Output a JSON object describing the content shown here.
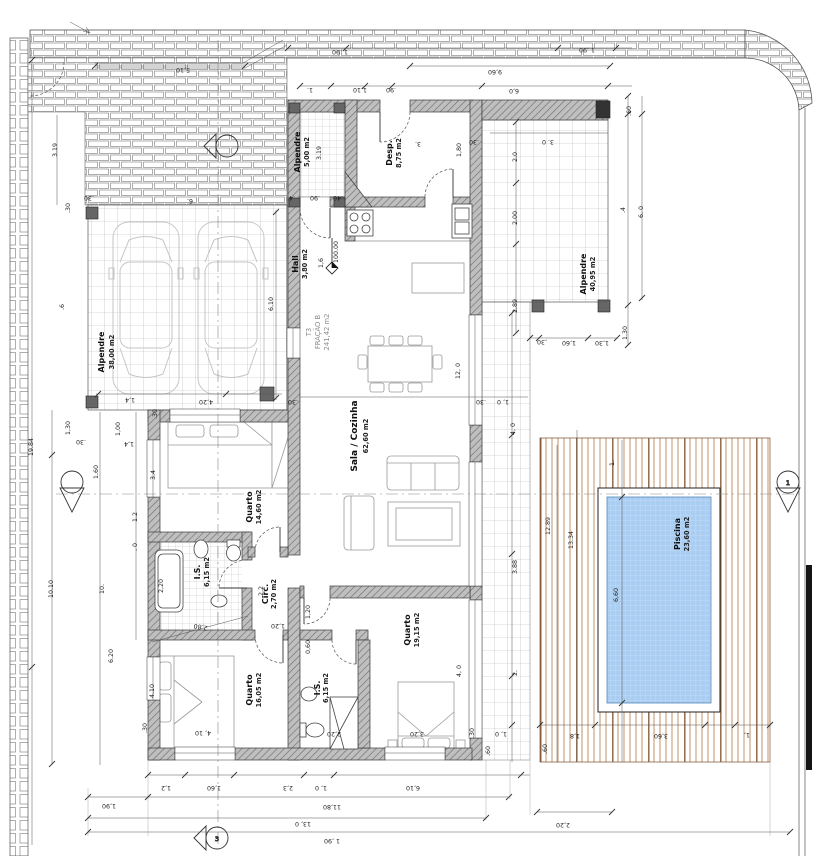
{
  "rooms": [
    {
      "name": "Alpendre",
      "area": "38,00 m2"
    },
    {
      "name": "Alpendre",
      "area": "5,00 m2"
    },
    {
      "name": "Desp.",
      "area": "8,75 m2"
    },
    {
      "name": "Hall",
      "area": "3,80 m2"
    },
    {
      "name": "Sala / Cozinha",
      "area": "62,60 m2"
    },
    {
      "name": "Quarto",
      "area": "14,60 m2"
    },
    {
      "name": "I.S.",
      "area": "6,15 m2"
    },
    {
      "name": "Circ.",
      "area": "2,70 m2"
    },
    {
      "name": "Quarto",
      "area": "16,05 m2"
    },
    {
      "name": "I.S.",
      "area": "6,15 m2"
    },
    {
      "name": "Quarto",
      "area": "19,15 m2"
    },
    {
      "name": "Alpendre",
      "area": "40,95 m2"
    },
    {
      "name": "Piscina",
      "area": "23,60 m2"
    }
  ],
  "unit": {
    "l1": "T3",
    "l2": "FRAÇÃO B",
    "l3": "241,42 m2"
  },
  "level": {
    "value": "100.00"
  },
  "markers": {
    "top": "",
    "left": "",
    "right": "1",
    "bottom": "3"
  },
  "dims": [
    "1 ,90",
    "1 ,90",
    "5,10",
    "9,60",
    "1.",
    "1,10",
    ".90",
    "6,0",
    "3.",
    "1,80",
    ".30",
    "3. 0",
    "2.0",
    "2.00",
    "2.89",
    ".60",
    ".4",
    "6. 0",
    "1.30",
    ",30",
    "1,60",
    "1,30",
    "3.19",
    ".30",
    ".30",
    "6.",
    "19.84",
    ".6",
    "6.10",
    "4,20",
    "1,4",
    ".30",
    "1,00",
    "1,4",
    "1,30",
    ".30",
    ".4",
    ".90",
    ".40",
    "3.4",
    "1.60",
    "1.2",
    ". 0",
    "10.10",
    "10.",
    "6.20",
    "4.10",
    ".30",
    "2,20",
    "2.2",
    "2,80",
    "1,20",
    "0,60",
    "2,20",
    "3,20",
    "4, 0",
    "12, 0",
    ".30",
    ".30",
    "1, 0",
    "4, 0",
    "3.88",
    "2.",
    ".30",
    "1, 0",
    ".60",
    ".60",
    "12.89",
    "13.34",
    "1.",
    "6,60",
    "1,8",
    "3,60",
    "1,",
    "4, 10",
    "1,2",
    "1,60",
    "2,3",
    "1, 0",
    "6,10",
    "1,90",
    "11,80",
    "13, 0",
    "2,20",
    "1 ,90",
    "1,6",
    "1,20",
    "3.19"
  ],
  "colors": {
    "wall": "#bfbfbf",
    "wall_hatch": "#707070",
    "deck_slat": "#c09066",
    "deck_dark": "#8a5f3a",
    "pool_water": "#aacdf2",
    "pool_grid": "#c9dff7",
    "brick": "#888888"
  }
}
